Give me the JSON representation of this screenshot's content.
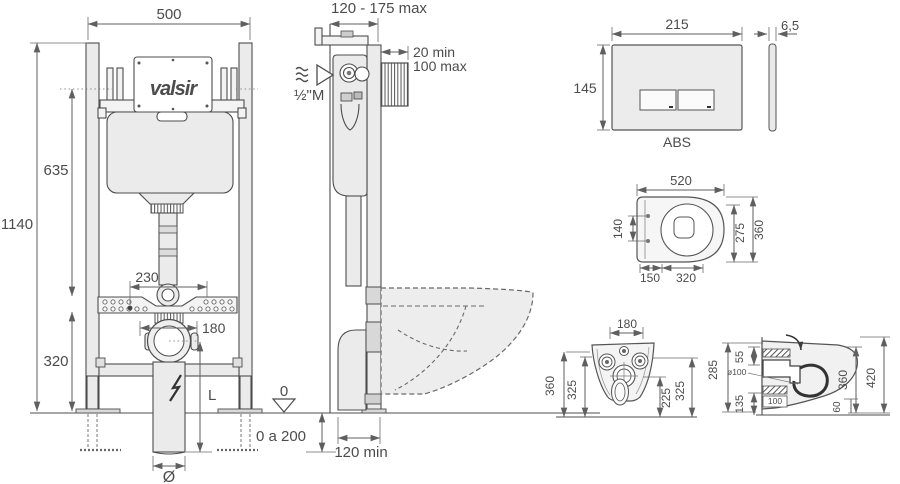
{
  "front_view": {
    "width": "500",
    "total_height": "1140",
    "tank_height": "635",
    "lower_height": "320",
    "supply_offset": "230",
    "outlet_offset": "180",
    "pipe_length": "L",
    "pipe_diameter": "Ø",
    "floor_range": "0 a 200",
    "datum": "0",
    "brand": "valsir"
  },
  "installation_side": {
    "depth": "120 - 175 max",
    "conduit_min": "20 min",
    "conduit_max": "100 max",
    "water_connection": "½\"M",
    "base_depth": "120 min"
  },
  "flush_plate": {
    "width": "215",
    "height": "145",
    "thickness": "6,5",
    "material": "ABS"
  },
  "pan_top": {
    "length": "520",
    "fixing_span": "140",
    "inner_depth": "275",
    "width": "360",
    "rear_span": "150",
    "front_span": "320"
  },
  "pan_rear": {
    "fixing_span": "180",
    "outer_height": "360",
    "inner_height": "325",
    "outlet_height": "225",
    "side_height": "325"
  },
  "pan_side": {
    "top_gap": "55",
    "height": "285",
    "outlet_dia": "ø100",
    "ref": "100",
    "bottom_gap": "135",
    "depth": "360",
    "total_depth": "420",
    "rim_gap": "60"
  }
}
